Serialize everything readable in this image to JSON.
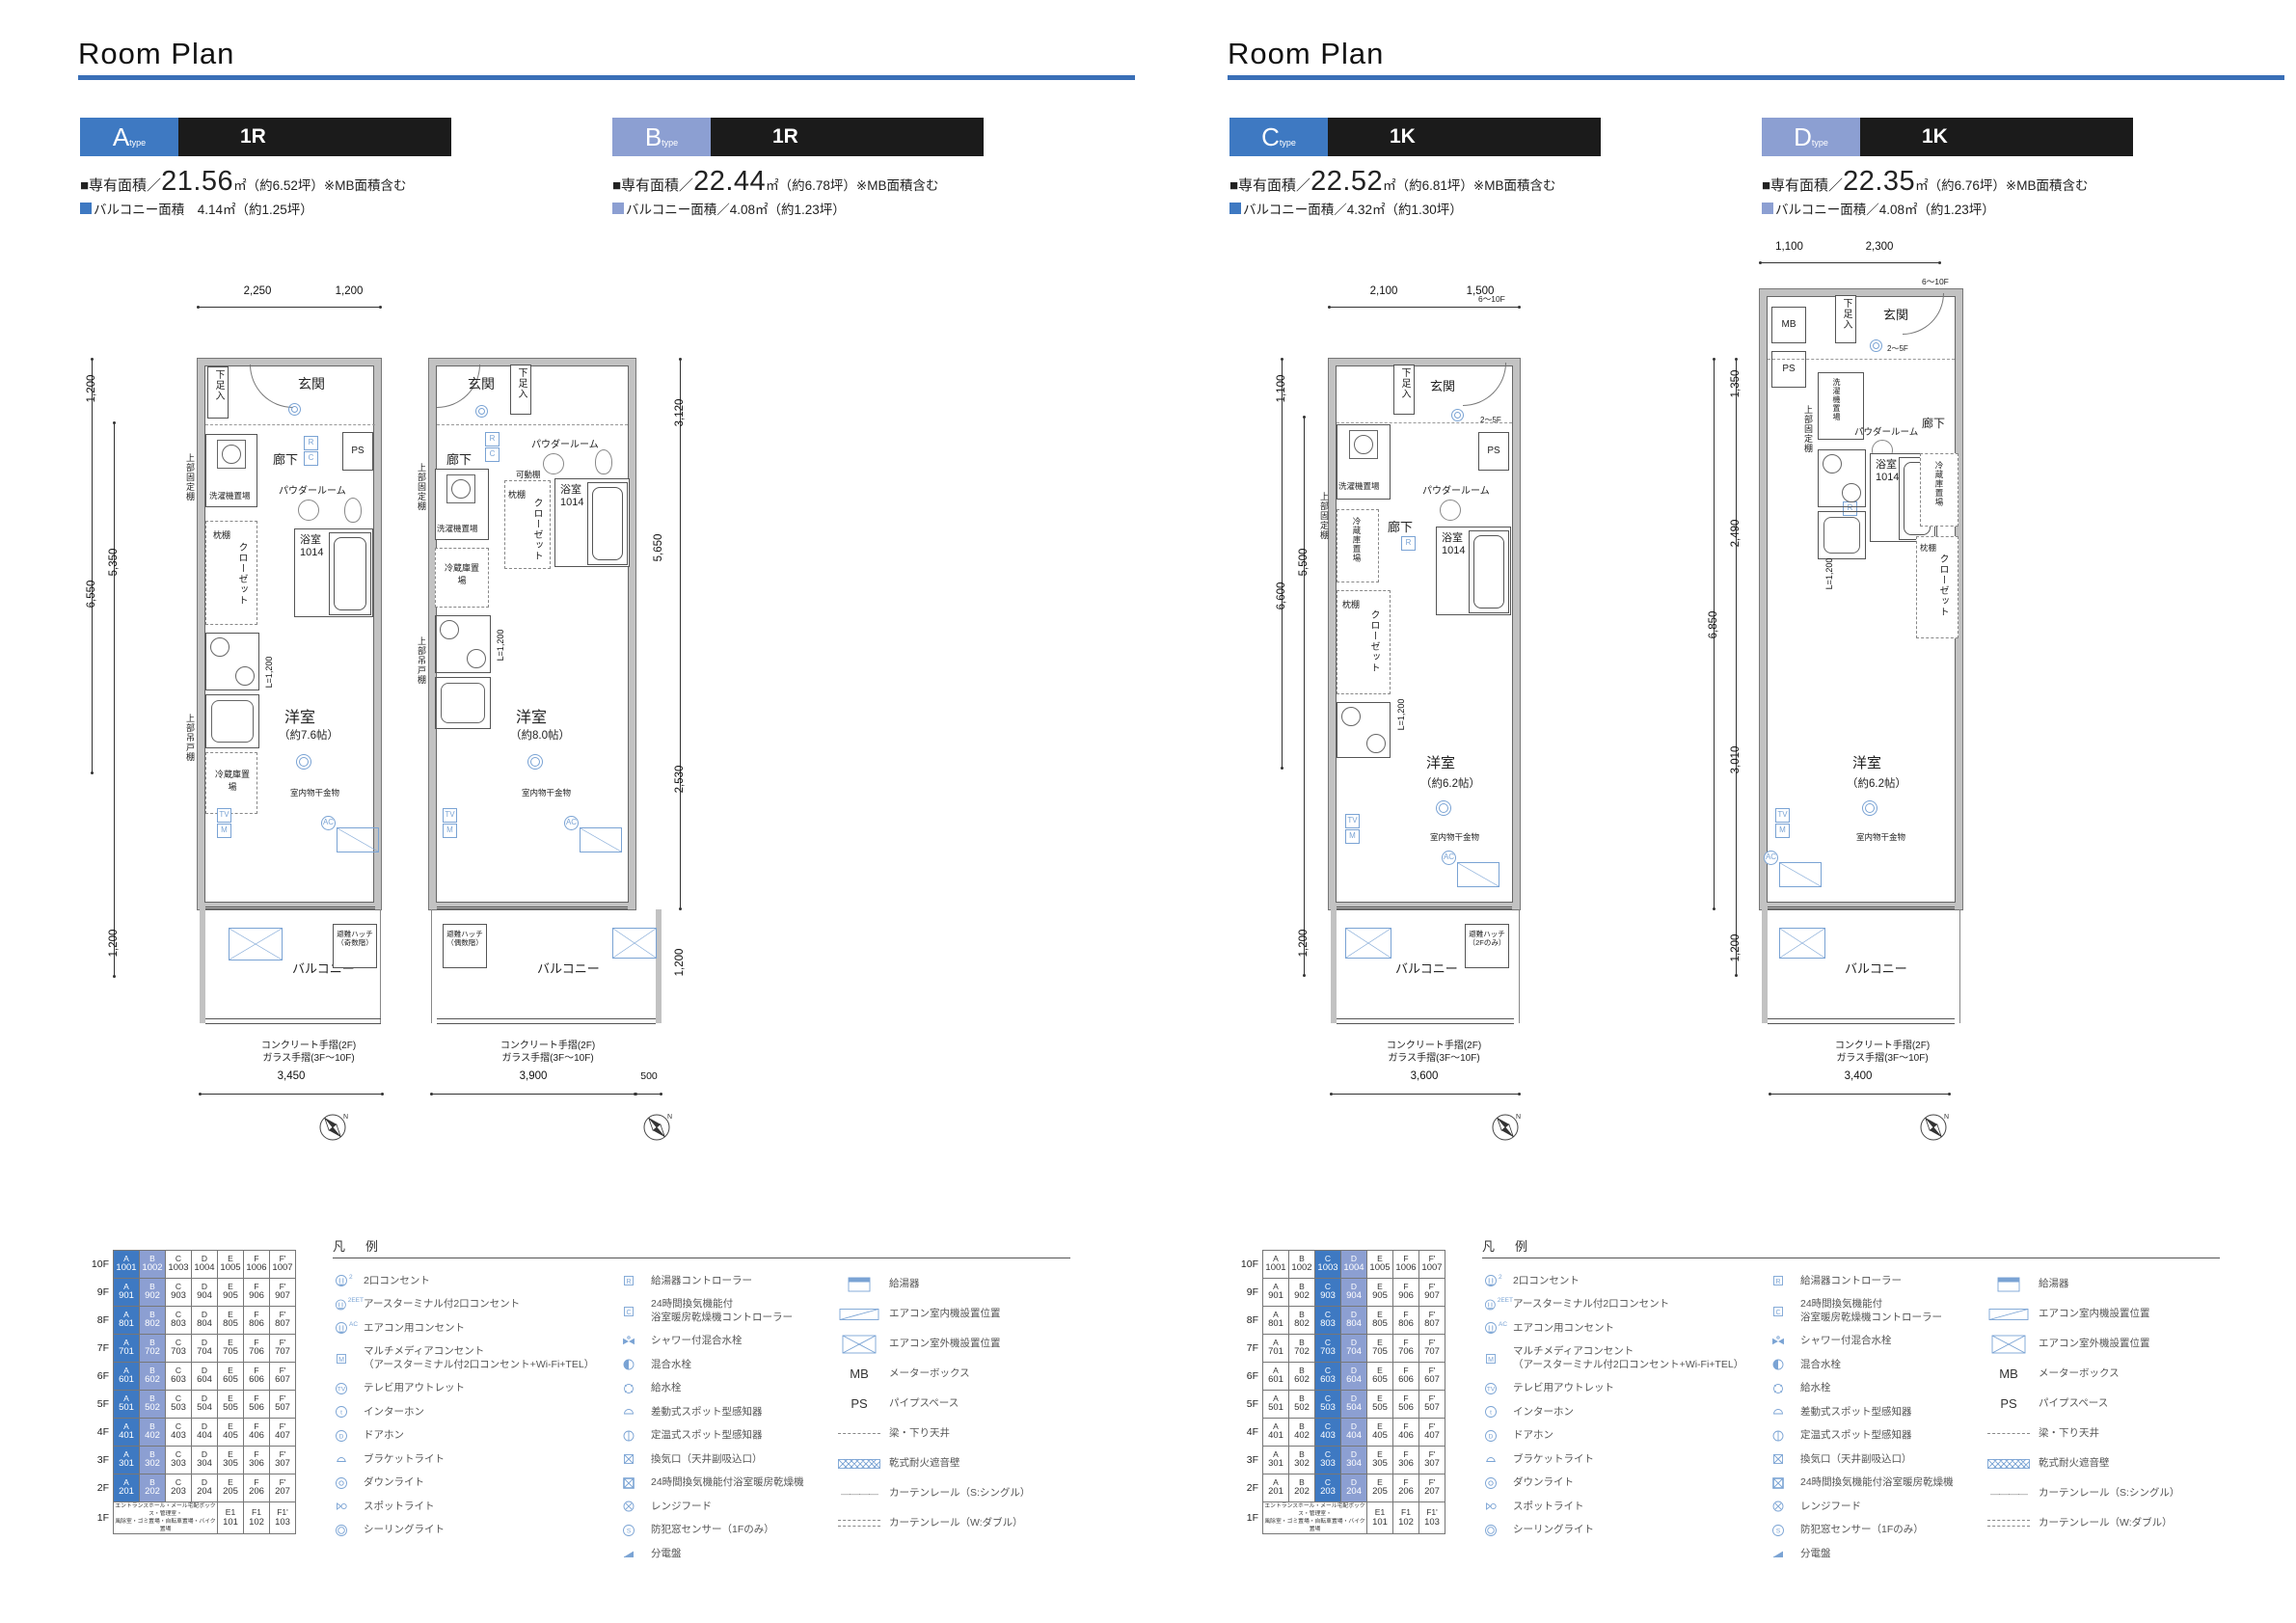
{
  "colors": {
    "dark": "#3e79c2",
    "light": "#8c9fd2",
    "rule": "#3a6fb7",
    "fixture": "#7aa3d4",
    "wall": "#c2c2c2",
    "bar": "#1b1b1b"
  },
  "page_title": "Room Plan",
  "labels": {
    "genkan": "玄関",
    "shoebox": "下足入",
    "ps": "PS",
    "mb": "MB",
    "rouka": "廊下",
    "powder": "パウダールーム",
    "bath_name": "浴室",
    "bath_size": "1014",
    "washer": "洗濯機置場",
    "closet": "クローゼット",
    "makura": "枕棚",
    "kadou": "可動棚",
    "fridge": "冷蔵庫置場",
    "upfix": "上部固定棚",
    "uphang": "上部吊戸棚",
    "room": "洋室",
    "monohoshi": "室内物干金物",
    "balcony": "バルコニー",
    "rail1": "コンクリート手摺(2F)",
    "rail2": "ガラス手摺(3F〜10F)",
    "l1200": "L=1,200",
    "legend_title": "凡　例",
    "sym_r": "R",
    "sym_c": "C",
    "sym_tv": "TV",
    "sym_m": "M",
    "sym_ac": "AC"
  },
  "plans": [
    {
      "key": "A",
      "badge": "A",
      "badge_sub": "type",
      "layout": "1R",
      "tone": "dark",
      "area_prefix": "■専有面積／",
      "area_value": "21.56",
      "area_suffix": "㎡（約6.52坪）※MB面積含む",
      "balcony_line": "バルコニー面積　4.14㎡（約1.25坪）",
      "size": "（約7.6帖）",
      "hatch1": "避難ハッチ",
      "hatch2": "（奇数階）",
      "dims": {
        "t1": "2,250",
        "t2": "1,200",
        "l1": "1,200",
        "l2": "6,550",
        "l3": "5,350",
        "l4": "1,200",
        "b1": "3,450"
      }
    },
    {
      "key": "B",
      "badge": "B",
      "badge_sub": "type",
      "layout": "1R",
      "tone": "light",
      "area_prefix": "■専有面積／",
      "area_value": "22.44",
      "area_suffix": "㎡（約6.78坪）※MB面積含む",
      "balcony_line": "バルコニー面積／4.08㎡（約1.23坪）",
      "size": "（約8.0帖）",
      "hatch1": "避難ハッチ",
      "hatch2": "（偶数階）",
      "dims": {
        "r1": "3,120",
        "r2": "5,650",
        "r3": "2,530",
        "r4": "1,200",
        "b1": "3,900",
        "b2": "500"
      }
    },
    {
      "key": "C",
      "badge": "C",
      "badge_sub": "type",
      "layout": "1K",
      "tone": "dark",
      "area_prefix": "■専有面積／",
      "area_value": "22.52",
      "area_suffix": "㎡（約6.81坪）※MB面積含む",
      "balcony_line": "バルコニー面積／4.32㎡（約1.30坪）",
      "size": "（約6.2帖）",
      "hatch1": "避難ハッチ",
      "hatch2": "（2Fのみ）",
      "dims": {
        "t1": "2,100",
        "t2": "1,500",
        "l1": "1,100",
        "l2": "6,600",
        "l3": "5,500",
        "l4": "1,200",
        "b1": "3,600",
        "n1": "6〜10F",
        "n2": "2〜5F"
      }
    },
    {
      "key": "D",
      "badge": "D",
      "badge_sub": "type",
      "layout": "1K",
      "tone": "light",
      "area_prefix": "■専有面積／",
      "area_value": "22.35",
      "area_suffix": "㎡（約6.76坪）※MB面積含む",
      "balcony_line": "バルコニー面積／4.08㎡（約1.23坪）",
      "size": "（約6.2帖）",
      "hatch1": "",
      "hatch2": "",
      "dims": {
        "t1": "1,100",
        "t2": "2,300",
        "lo": "6,850",
        "l1": "1,350",
        "l2": "2,490",
        "l3": "3,010",
        "l4": "1,200",
        "b1": "3,400",
        "n1": "6〜10F",
        "n2": "2〜5F"
      }
    }
  ],
  "table": {
    "letters": [
      "A",
      "B",
      "C",
      "D",
      "E",
      "F",
      "F'"
    ],
    "rows": [
      {
        "floor": "10F",
        "nums": [
          "1001",
          "1002",
          "1003",
          "1004",
          "1005",
          "1006",
          "1007"
        ]
      },
      {
        "floor": "9F",
        "nums": [
          "901",
          "902",
          "903",
          "904",
          "905",
          "906",
          "907"
        ]
      },
      {
        "floor": "8F",
        "nums": [
          "801",
          "802",
          "803",
          "804",
          "805",
          "806",
          "807"
        ]
      },
      {
        "floor": "7F",
        "nums": [
          "701",
          "702",
          "703",
          "704",
          "705",
          "706",
          "707"
        ]
      },
      {
        "floor": "6F",
        "nums": [
          "601",
          "602",
          "603",
          "604",
          "605",
          "606",
          "607"
        ]
      },
      {
        "floor": "5F",
        "nums": [
          "501",
          "502",
          "503",
          "504",
          "505",
          "506",
          "507"
        ]
      },
      {
        "floor": "4F",
        "nums": [
          "401",
          "402",
          "403",
          "404",
          "405",
          "406",
          "407"
        ]
      },
      {
        "floor": "3F",
        "nums": [
          "301",
          "302",
          "303",
          "304",
          "305",
          "306",
          "307"
        ]
      },
      {
        "floor": "2F",
        "nums": [
          "201",
          "202",
          "203",
          "204",
          "205",
          "206",
          "207"
        ]
      }
    ],
    "floor1": {
      "floor": "1F",
      "note1": "エントランスホール・メール宅配ボックス・管理室・",
      "note2": "風除室・ゴミ置場・自転車置場・バイク置場",
      "cells": [
        [
          "E1",
          "101"
        ],
        [
          "F1",
          "102"
        ],
        [
          "F1'",
          "103"
        ]
      ]
    }
  },
  "legend": {
    "col1": [
      {
        "icon": "o2",
        "sup": "2",
        "label": "2口コンセント"
      },
      {
        "icon": "o2",
        "sup": "2EET",
        "label": "アースターミナル付2口コンセント"
      },
      {
        "icon": "o2",
        "sup": "AC",
        "label": "エアコン用コンセント"
      },
      {
        "icon": "m",
        "label": "マルチメディアコンセント",
        "label2": "（アースターミナル付2口コンセント+Wi-Fi+TEL）",
        "tall": true
      },
      {
        "icon": "tv",
        "label": "テレビ用アウトレット"
      },
      {
        "icon": "t",
        "label": "インターホン"
      },
      {
        "icon": "d",
        "label": "ドアホン"
      },
      {
        "icon": "bracket",
        "label": "ブラケットライト"
      },
      {
        "icon": "down",
        "label": "ダウンライト"
      },
      {
        "icon": "spot",
        "label": "スポットライト"
      },
      {
        "icon": "ceil",
        "label": "シーリングライト"
      }
    ],
    "col2": [
      {
        "icon": "rbox",
        "label": "給湯器コントローラー"
      },
      {
        "icon": "cbox",
        "label": "24時間換気機能付",
        "label2": "浴室暖房乾燥機コントローラー",
        "tall": true
      },
      {
        "icon": "shower",
        "label": "シャワー付混合水栓"
      },
      {
        "icon": "mix",
        "label": "混合水栓"
      },
      {
        "icon": "water",
        "label": "給水栓"
      },
      {
        "icon": "sado",
        "label": "差動式スポット型感知器"
      },
      {
        "icon": "teio",
        "label": "定温式スポット型感知器"
      },
      {
        "icon": "vent",
        "label": "換気口（天井副吸込口）"
      },
      {
        "icon": "vent24",
        "label": "24時間換気機能付浴室暖房乾燥機"
      },
      {
        "icon": "range",
        "label": "レンジフード"
      },
      {
        "icon": "sens",
        "label": "防犯窓センサー（1Fのみ）"
      },
      {
        "icon": "bund",
        "label": "分電盤"
      }
    ],
    "col3": [
      {
        "icon": "boiler",
        "label": "給湯器"
      },
      {
        "icon": "acin",
        "label": "エアコン室内機設置位置"
      },
      {
        "icon": "acout",
        "label": "エアコン室外機設置位置"
      },
      {
        "icon": "mbtxt",
        "label": "メーターボックス"
      },
      {
        "icon": "pstxt",
        "label": "パイプスペース"
      },
      {
        "icon": "dash",
        "label": "梁・下り天井"
      },
      {
        "icon": "hatchw",
        "label": "乾式耐火遮音壁"
      },
      {
        "icon": "dashdot",
        "label": "カーテンレール（S:シングル）"
      },
      {
        "icon": "ddash",
        "label": "カーテンレール（W:ダブル）"
      }
    ]
  }
}
